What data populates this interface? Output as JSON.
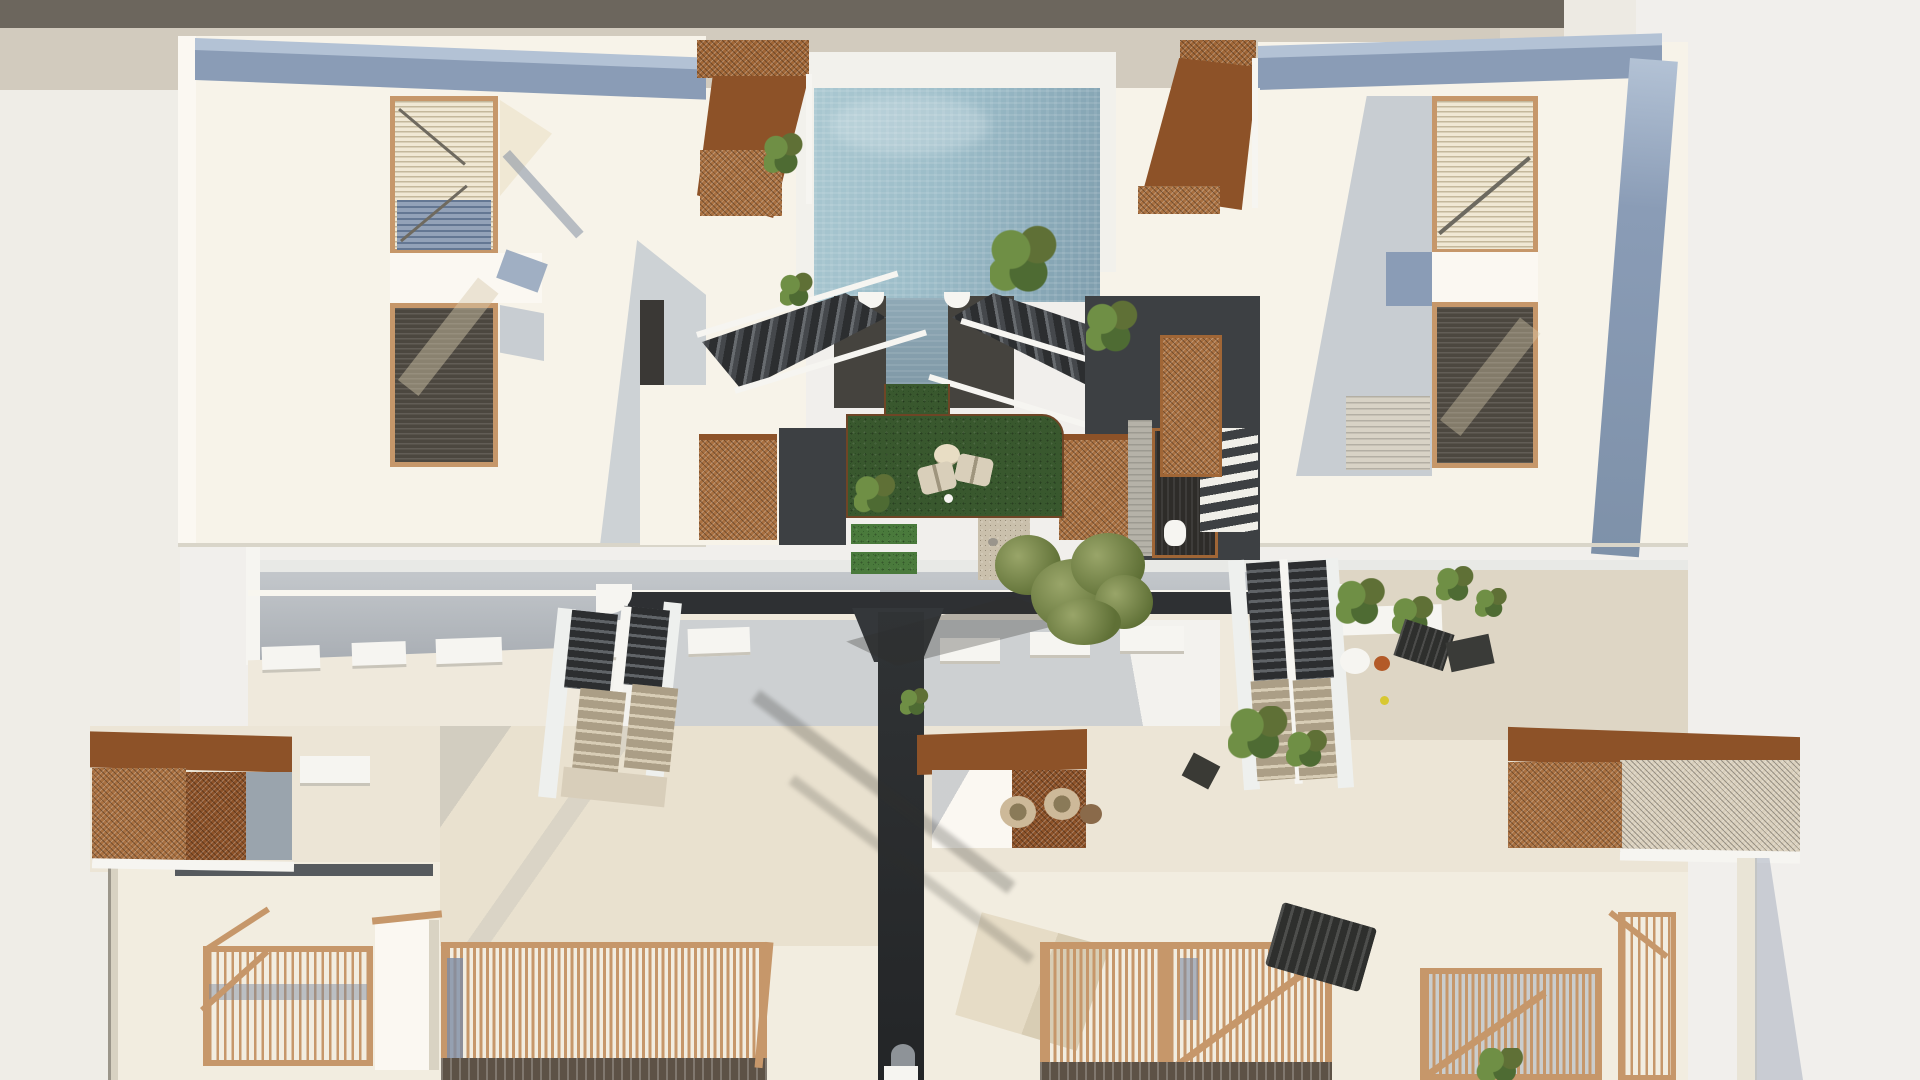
{
  "meta": {
    "title": "Aerial top-down 3D architectural render of a residential complex with courtyard pool, lawn, stairs, corten pergolas and wood balustrades",
    "view": "top-down render, no visible text or UI controls"
  },
  "palette": {
    "bg": "#f1efec",
    "bgWarm": "#efede7",
    "topBand": "#6c665d",
    "beigeBand": "#d2cbbe",
    "beigeBandLight": "#ddd6ca",
    "pillar": "#edeae3",
    "cream": "#f7f3e9",
    "creamBright": "#fbf8f2",
    "creamRoof": "#efe9dc",
    "creamTerrace": "#ece5d6",
    "facade": "#f2ede0",
    "fasciaBlue": "#8a9cb6",
    "fasciaBlueLight": "#b3c2d5",
    "shadeBlue": "#8e9fb6",
    "wood": "#c6976a",
    "slatCream": "#f0e8d4",
    "slatShadowBlue": "#93a2b8",
    "slatDark": "#4c473f",
    "corten": "#a06636",
    "cortenDark": "#8d5228",
    "cortenMesh": "#a97040",
    "meshCream": "#d9cfbc",
    "poolLight": "#aac8d1",
    "poolMid": "#9bbcc8",
    "poolDark": "#7e9dad",
    "poolRim": "#f2f1ec",
    "charcoal": "#3d4043",
    "charcoalDark": "#2c2e30",
    "walkTop": "#c3c7cb",
    "walkBottom": "#a8adb3",
    "ledge": "#e8e9e6",
    "grass": "#39582e",
    "grassLight": "#4a7a3c",
    "gravel": "#cac0ac",
    "travertine": "#e9e1cf",
    "travertineShade": "#ded6c5",
    "treeGreen": "#8d9a5e",
    "treeDark": "#5f7036",
    "plantGreen": "#6f8f45",
    "plantDark": "#4e6b33",
    "furnCream": "#d9cfba",
    "tableCream": "#e8ddc4",
    "potOrange": "#b35a28",
    "lemonYellow": "#d8c832",
    "stairTan": "#ab9e86",
    "stairTanLight": "#d8cdb6",
    "white": "#f6f5f1",
    "roofEdge": "#565a5e"
  },
  "objects": {
    "pool": {
      "label": "courtyard swimming pool"
    },
    "lawn": {
      "label": "sunken lawn courtyard with lounge chairs"
    },
    "tree": {
      "label": "central courtyard tree"
    },
    "leftBuilding": {
      "label": "upper-left apartment block with louvered balconies"
    },
    "rightBuilding": {
      "label": "upper-right apartment block with louvered balconies"
    },
    "lowerLeftBuilding": {
      "label": "lower-left roof terraces with corten pergola and wood balustrades"
    },
    "lowerRightBuilding": {
      "label": "lower-right roof terraces with corten pergolas and wood balustrades"
    },
    "poolStairs": {
      "label": "twin staircases flanking the pool"
    },
    "walkway": {
      "label": "elevated walkway between the blocks"
    },
    "centralPath": {
      "label": "dark central footpath"
    }
  }
}
